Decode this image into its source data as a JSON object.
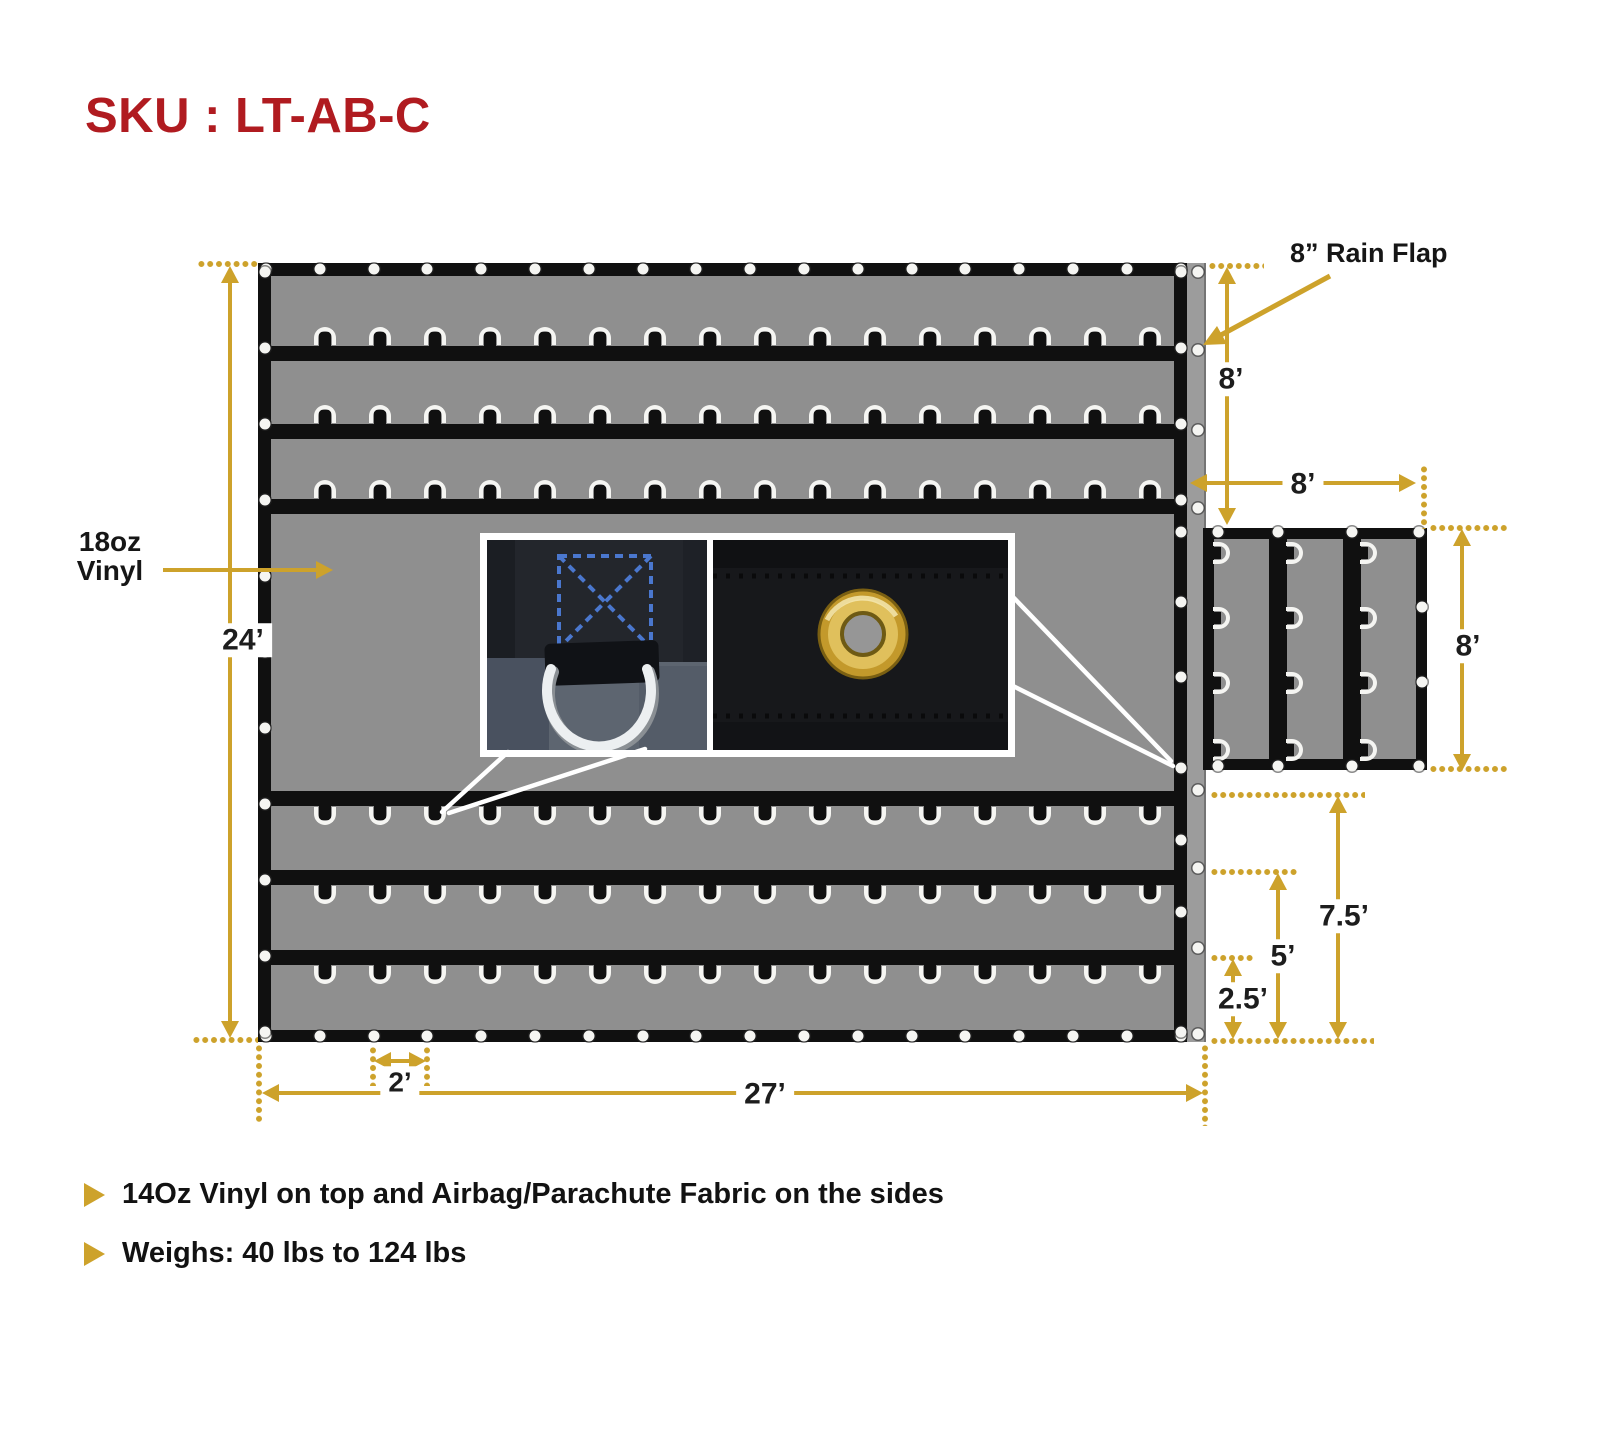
{
  "page": {
    "title": "SKU : LT-AB-C"
  },
  "colors": {
    "red": "#B01B20",
    "gold": "#CDA22B",
    "black": "#101010",
    "tarpgray": "#8F8F8F",
    "flapgray": "#9C9C9C",
    "ringwhite": "#F5F5F2",
    "stitchblue": "#4A77CE",
    "brass": "#C3992B"
  },
  "diagram": {
    "material_label": {
      "line1": "18oz",
      "line2": "Vinyl"
    },
    "rain_flap_label": "8” Rain Flap",
    "dims": {
      "height": "24’",
      "width": "27’",
      "spacing": "2’",
      "flap_drop": "8’",
      "side_width": "8’",
      "side_height": "8’",
      "d75": "7.5’",
      "d5": "5’",
      "d25": "2.5’"
    },
    "hardware": {
      "rings_per_row": 16,
      "top_ring_stripes_y": [
        346,
        424,
        499
      ],
      "bottom_ring_stripes_y": [
        806,
        885,
        965
      ],
      "grommets_h_edge": 18,
      "grommets_left_edge": 11,
      "right_edge_grommets_y": [
        272,
        348,
        424,
        500,
        532,
        602,
        677,
        768,
        840,
        912,
        1032
      ],
      "flap_strip_grommets_y": [
        272,
        350,
        430,
        508,
        790,
        868,
        948,
        1034
      ],
      "side_panel_columns": 3,
      "side_panel_rings_per_column": 4,
      "closeups": {
        "left_photo": "d-ring-stitched-webbing",
        "right_photo": "brass-grommet"
      }
    }
  },
  "footer": {
    "bullets": [
      "14Oz Vinyl on top and Airbag/Parachute Fabric on the sides",
      "Weighs: 40 lbs to 124 lbs"
    ]
  }
}
